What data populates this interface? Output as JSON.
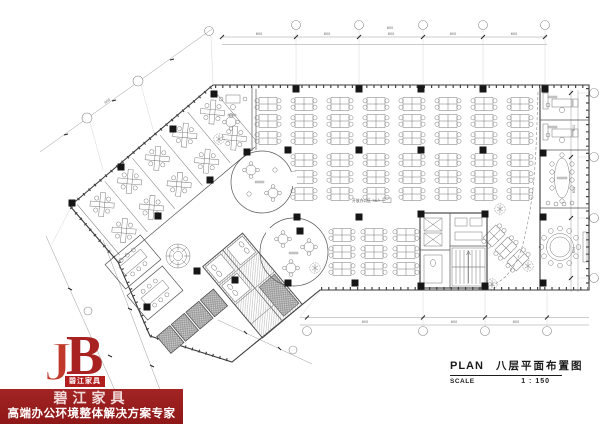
{
  "logo": {
    "letter_j": "J",
    "letter_b": "B",
    "box_label": "碧江家具",
    "company": "碧江家具",
    "tagline": "高端办公环境整体解决方案专家",
    "brand_red": "#9b1d1d"
  },
  "title_block": {
    "plan_label": "PLAN",
    "plan_title": "八层平面布置图",
    "scale_label": "SCALE",
    "scale_value": "1 : 150"
  },
  "plan": {
    "open_office_label": "开放办公区 36人",
    "dim_label": "600"
  }
}
